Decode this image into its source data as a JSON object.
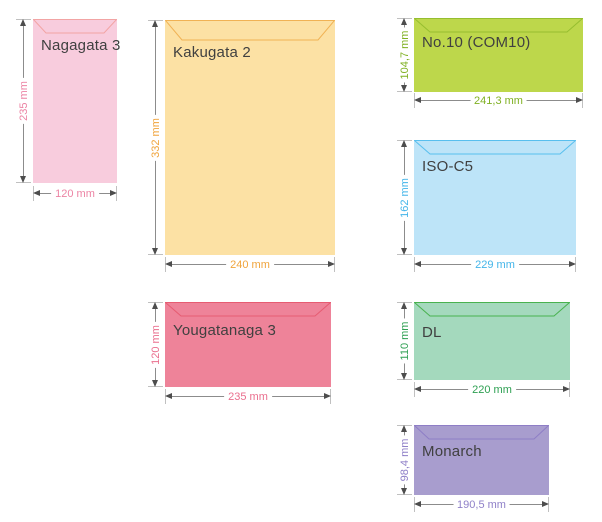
{
  "text_color": "#404040",
  "dimension_line_color": "#8c8c8c",
  "arrowhead_color": "#4d4d4d",
  "envelopes": [
    {
      "id": "nagagata-3",
      "label": "Nagagata 3",
      "height": "235 mm",
      "width": "120 mm",
      "fill": "#f8ccdd",
      "flap": "#f2a4a4",
      "accent": "#ec84a4"
    },
    {
      "id": "kakugata-2",
      "label": "Kakugata 2",
      "height": "332 mm",
      "width": "240 mm",
      "fill": "#fce1a4",
      "flap": "#f0b254",
      "accent": "#f0a43c"
    },
    {
      "id": "no10-com10",
      "label": "No.10 (COM10)",
      "height": "104,7 mm",
      "width": "241,3 mm",
      "fill": "#bdd74b",
      "flap": "#96be2f",
      "accent": "#7fb022"
    },
    {
      "id": "iso-c5",
      "label": "ISO-C5",
      "height": "162 mm",
      "width": "229 mm",
      "fill": "#bde4f8",
      "flap": "#58bfee",
      "accent": "#44b5e9"
    },
    {
      "id": "yougatanaga-3",
      "label": "Yougatanaga 3",
      "height": "120 mm",
      "width": "235 mm",
      "fill": "#ee8399",
      "flap": "#e65c72",
      "accent": "#ea6f8e"
    },
    {
      "id": "dl",
      "label": "DL",
      "height": "110 mm",
      "width": "220 mm",
      "fill": "#a4d9bd",
      "flap": "#49b24f",
      "accent": "#2ea052"
    },
    {
      "id": "monarch",
      "label": "Monarch",
      "height": "98,4 mm",
      "width": "190,5 mm",
      "fill": "#a89dce",
      "flap": "#8e7ec6",
      "accent": "#8f80c8"
    }
  ]
}
